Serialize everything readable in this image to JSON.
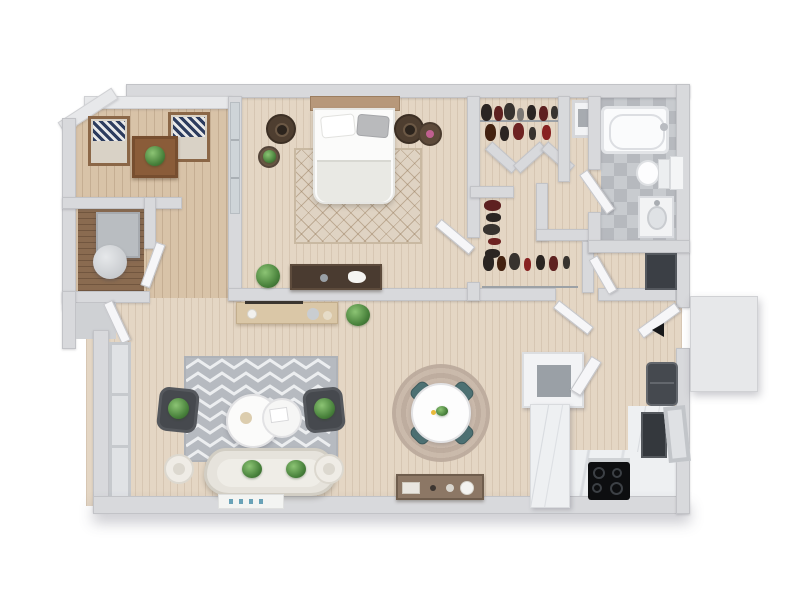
{
  "image_type": "3d-rendered-floor-plan-top-view",
  "visible_text": "none",
  "background_color": "#ffffff",
  "palette": {
    "wall": "#d8d9dc",
    "wall_highlight": "#e7e8ea",
    "wood_floor": "#e4d6c4",
    "patio_floor": "#d8c3a8",
    "nook_floor": "#8a6b50",
    "bathroom_tile": "#c6c9cd",
    "marble_counter": "#eef0f2",
    "living_rug": "#b6bac0",
    "bedroom_rug": "#dfd3c3",
    "dining_rug": "#c4b3a5",
    "sofa": "#e6e3dc",
    "armchair": "#46494e",
    "dining_chair_teal": "#4d7173",
    "appliance_dark": "#34383d",
    "cooktop_black": "#0d0e10",
    "plant_green": "#49823c",
    "wood_dark_furniture": "#4a3b30"
  },
  "rooms": {
    "patio": {
      "name": "Patio / Balcony",
      "furniture": [
        "lounge-chair",
        "lounge-chair",
        "wood-side-table",
        "potted-plant",
        "storage-nook-desk",
        "stool"
      ]
    },
    "bedroom": {
      "name": "Bedroom",
      "furniture": [
        "queen-bed",
        "pillows",
        "nightstand-left",
        "nightstand-right",
        "table-lamp",
        "diamond-area-rug",
        "dresser",
        "potted-plant",
        "sliding-glass-door"
      ]
    },
    "closet": {
      "name": "Walk-in Closet",
      "furniture": [
        "clothes-rack-top",
        "clothes-rack-side",
        "clothes-rack-bottom",
        "shelf-niche"
      ]
    },
    "bathroom": {
      "name": "Bathroom",
      "furniture": [
        "bathtub",
        "toilet",
        "vanity-sink",
        "tile-floor",
        "door"
      ]
    },
    "laundry": {
      "name": "Utility Closet",
      "furniture": [
        "dark-cabinet",
        "door"
      ]
    },
    "entry": {
      "name": "Entry Hall",
      "furniture": [
        "front-door",
        "exterior-landing"
      ]
    },
    "living": {
      "name": "Living Room",
      "furniture": [
        "chevron-rug",
        "curved-sofa",
        "armchair",
        "armchair",
        "nesting-coffee-tables",
        "side-table",
        "side-table",
        "console-table",
        "potted-plant",
        "wall-art",
        "windows"
      ]
    },
    "dining": {
      "name": "Dining Area",
      "furniture": [
        "round-rug",
        "round-dining-table",
        "dining-chair",
        "dining-chair",
        "dining-chair",
        "dining-chair",
        "sideboard"
      ]
    },
    "kitchen": {
      "name": "Kitchen",
      "furniture": [
        "peninsula-counter",
        "sink-cabinet",
        "cooktop",
        "oven",
        "refrigerator",
        "counter-window"
      ]
    }
  }
}
